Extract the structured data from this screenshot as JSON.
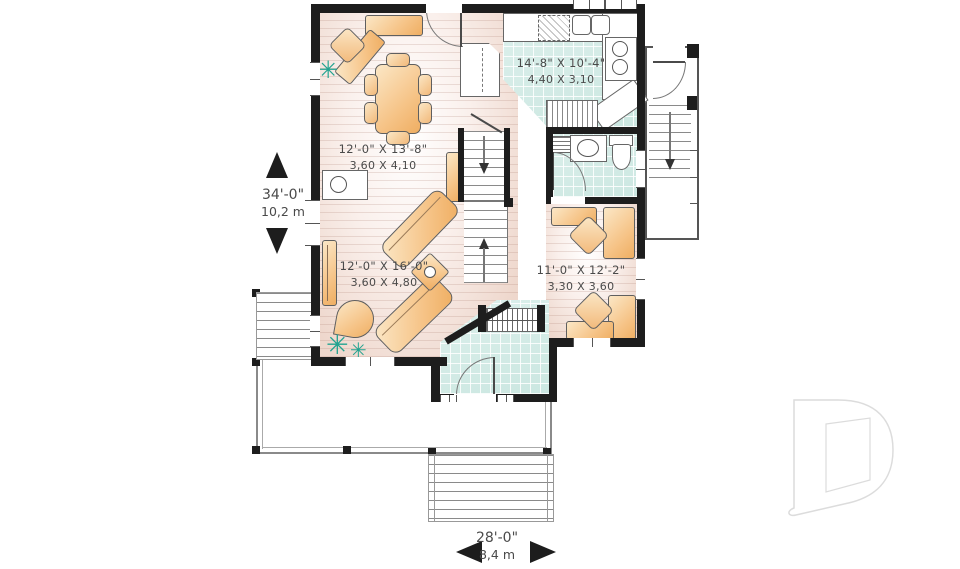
{
  "labels": {
    "kitchen": {
      "imperial": "14'-8\" X 10'-4\"",
      "metric": "4,40 X 3,10"
    },
    "dining": {
      "imperial": "12'-0\" X 13'-8\"",
      "metric": "3,60 X 4,10"
    },
    "living": {
      "imperial": "12'-0\" X 16'-0\"",
      "metric": "3,60 X 4,80"
    },
    "office": {
      "imperial": "11'-0\" X 12'-2\"",
      "metric": "3,30 X 3,60"
    }
  },
  "dimensions": {
    "vertical": {
      "feet": "34'-0\"",
      "meters": "10,2 m"
    },
    "horizontal": {
      "feet": "28'-0\"",
      "meters": "8,4 m"
    }
  },
  "icons": {
    "plant": "✳"
  },
  "logo": {
    "letter": "D"
  },
  "colors": {
    "wall": "#1d1d1d",
    "tile": "#cfe8e2",
    "furniture": "#f6c488",
    "plant": "#23a390",
    "text": "#4a4a4a",
    "logo_outline": "#dcdcdc"
  }
}
